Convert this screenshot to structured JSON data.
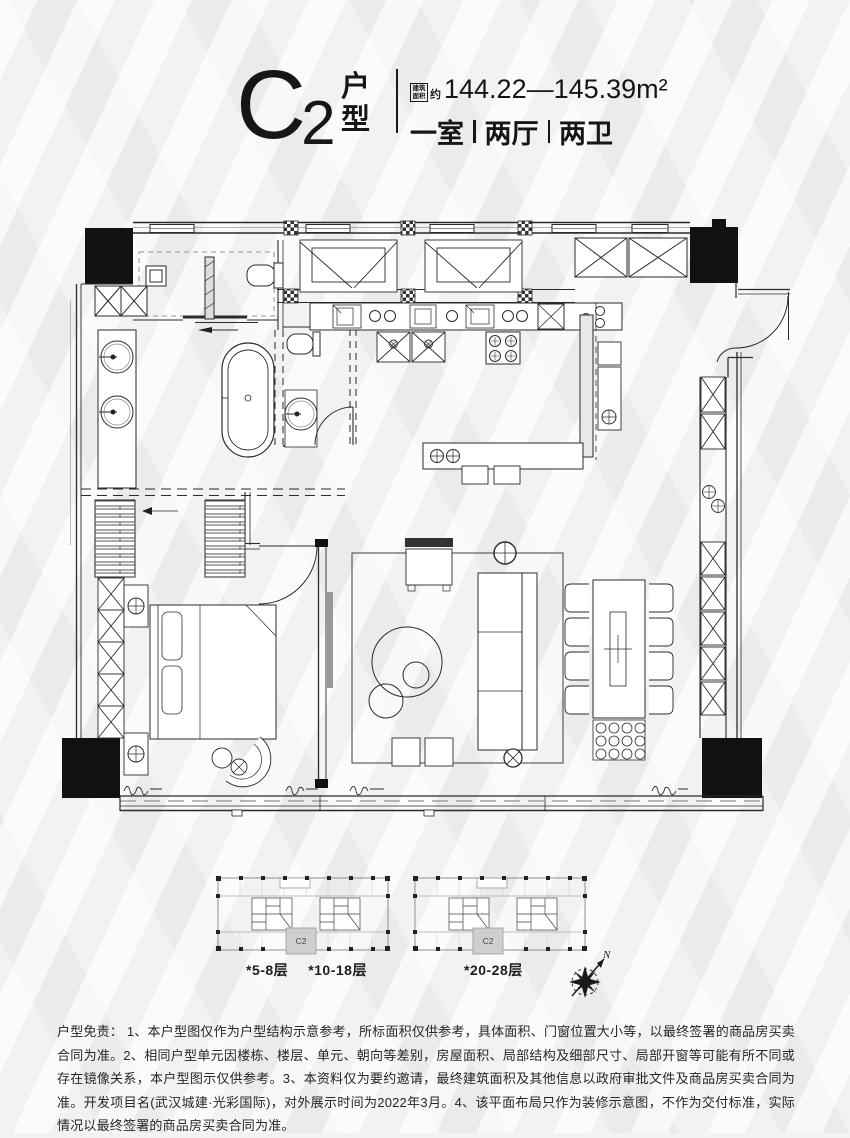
{
  "colors": {
    "ink": "#161616",
    "plan_line": "#2b2b2b",
    "bg": "#f3f3f2",
    "unit_fill": "#cfcfcf"
  },
  "header": {
    "unit_code_letter": "C",
    "unit_code_digit": "2",
    "unit_code_suffix": "户型",
    "area_badge": "建筑面积",
    "area_prefix": "约",
    "area_value": "144.22—145.39m²",
    "rooms": [
      "一室",
      "两厅",
      "两卫"
    ]
  },
  "key_plans": [
    {
      "unit_label": "C2",
      "floors": [
        "*5-8层",
        "*10-18层"
      ]
    },
    {
      "unit_label": "C2",
      "floors": [
        "*20-28层"
      ]
    }
  ],
  "compass": {
    "north_label": "N"
  },
  "disclaimer": {
    "text": "户型免责：  1、本户型图仅作为户型结构示意参考，所标面积仅供参考，具体面积、门窗位置大小等，以最终签署的商品房买卖合同为准。2、相同户型单元因楼栋、楼层、单元、朝向等差别，房屋面积、局部结构及细部尺寸、局部开窗等可能有所不同或存在镜像关系，本户型图示仅供参考。3、本资料仅为要约邀请，最终建筑面积及其他信息以政府审批文件及商品房买卖合同为准。开发项目名(武汉城建·光彩国际)，对外展示时间为2022年3月。4、该平面布局只作为装修示意图，不作为交付标准，实际情况以最终签署的商品房买卖合同为准。"
  }
}
